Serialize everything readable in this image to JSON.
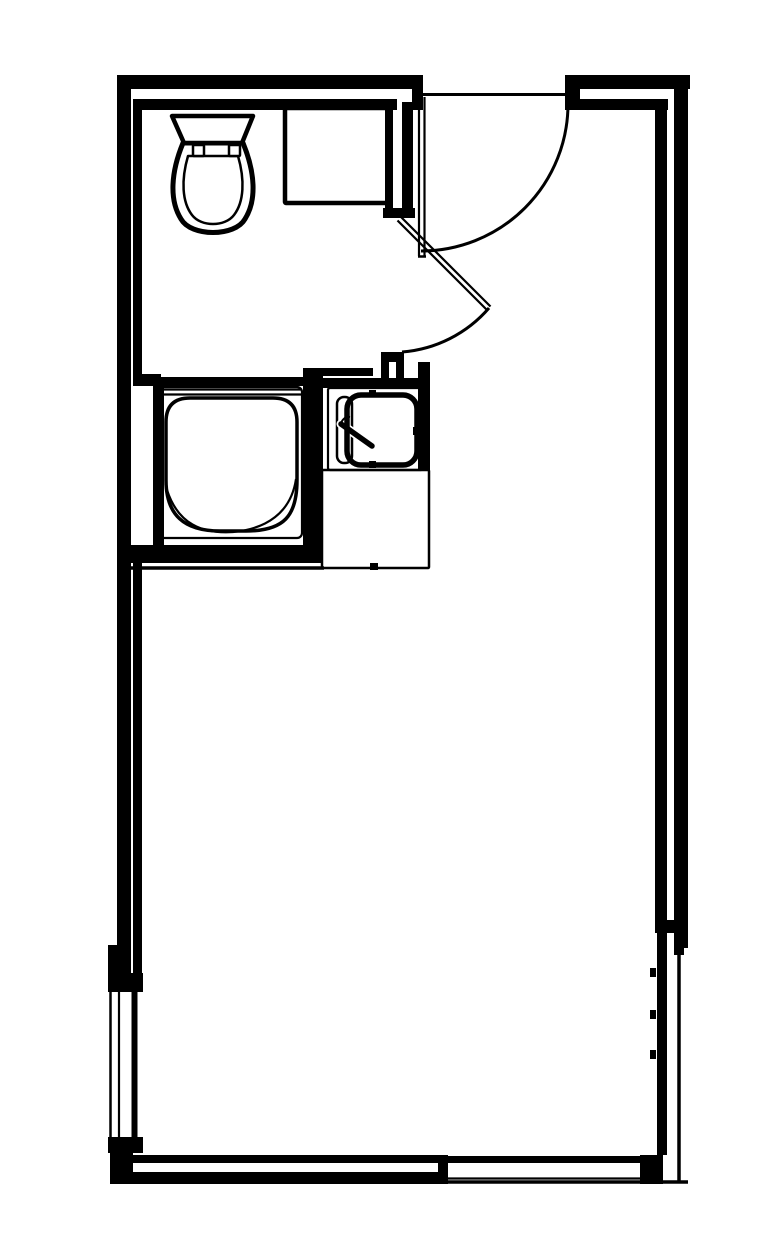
{
  "canvas": {
    "w": 783,
    "h": 1254,
    "bg": "#ffffff",
    "ink": "#000000"
  },
  "plan_meta": {
    "type": "architectural-floor-plan",
    "rooms": [
      "bathroom",
      "entry-vestibule",
      "main-room"
    ],
    "fixtures": [
      "toilet",
      "vanity-cabinet",
      "shower-stall",
      "sink",
      "entry-door",
      "bathroom-door",
      "left-window",
      "bottom-window"
    ]
  },
  "elements": [
    {
      "name": "wall-top-outer-left",
      "kind": "rect",
      "x": 117,
      "y": 75,
      "w": 306,
      "h": 14
    },
    {
      "name": "wall-top-inner-left",
      "kind": "rect",
      "x": 133,
      "y": 99,
      "w": 264,
      "h": 11
    },
    {
      "name": "entry-door-left-jamb",
      "kind": "rect",
      "x": 412,
      "y": 89,
      "w": 11,
      "h": 21
    },
    {
      "name": "wall-top-outer-right",
      "kind": "rect",
      "x": 565,
      "y": 75,
      "w": 125,
      "h": 14
    },
    {
      "name": "wall-top-inner-right",
      "kind": "rect",
      "x": 577,
      "y": 99,
      "w": 91,
      "h": 11
    },
    {
      "name": "entry-door-right-jamb",
      "kind": "rect",
      "x": 565,
      "y": 75,
      "w": 15,
      "h": 35
    },
    {
      "name": "wall-left-outer",
      "kind": "rect",
      "x": 117,
      "y": 75,
      "w": 14,
      "h": 873
    },
    {
      "name": "wall-left-outer-step",
      "kind": "rect",
      "x": 108,
      "y": 945,
      "w": 23,
      "h": 28
    },
    {
      "name": "wall-left-inner-upper",
      "kind": "rect",
      "x": 133,
      "y": 99,
      "w": 9,
      "h": 286
    },
    {
      "name": "bathroom-south-wall-el",
      "kind": "rect",
      "x": 133,
      "y": 374,
      "w": 28,
      "h": 12
    },
    {
      "name": "shower-left-wall",
      "kind": "rect",
      "x": 153,
      "y": 377,
      "w": 11,
      "h": 186
    },
    {
      "name": "shower-top-wall",
      "kind": "rect",
      "x": 161,
      "y": 377,
      "w": 144,
      "h": 9
    },
    {
      "name": "shower-right-wall",
      "kind": "rect",
      "x": 303,
      "y": 368,
      "w": 20,
      "h": 195
    },
    {
      "name": "sink-upper-wall-band",
      "kind": "rect",
      "x": 303,
      "y": 368,
      "w": 70,
      "h": 8
    },
    {
      "name": "sink-lower-wall-band",
      "kind": "rect",
      "x": 303,
      "y": 378,
      "w": 127,
      "h": 10
    },
    {
      "name": "door-stub-top",
      "kind": "rect",
      "x": 381,
      "y": 352,
      "w": 23,
      "h": 10
    },
    {
      "name": "door-stub-left-leg",
      "kind": "rect",
      "x": 381,
      "y": 360,
      "w": 8,
      "h": 19
    },
    {
      "name": "door-stub-right-leg",
      "kind": "rect",
      "x": 396,
      "y": 360,
      "w": 8,
      "h": 19
    },
    {
      "name": "sink-right-wall",
      "kind": "rect",
      "x": 418,
      "y": 362,
      "w": 12,
      "h": 108
    },
    {
      "name": "shower-bottom-wall",
      "kind": "rect",
      "x": 130,
      "y": 545,
      "w": 192,
      "h": 18
    },
    {
      "name": "wall-left-inner-lower",
      "kind": "rect",
      "x": 133,
      "y": 553,
      "w": 9,
      "h": 420
    },
    {
      "name": "left-window-top-jamb",
      "kind": "rect",
      "x": 108,
      "y": 973,
      "w": 35,
      "h": 19
    },
    {
      "name": "left-window-bottom-jamb",
      "kind": "rect",
      "x": 108,
      "y": 1137,
      "w": 35,
      "h": 16
    },
    {
      "name": "bottom-left-corner-post",
      "kind": "rect",
      "x": 110,
      "y": 1150,
      "w": 23,
      "h": 34
    },
    {
      "name": "wall-bottom-inner",
      "kind": "rect",
      "x": 133,
      "y": 1155,
      "w": 305,
      "h": 8
    },
    {
      "name": "wall-bottom-outer",
      "kind": "rect",
      "x": 110,
      "y": 1172,
      "w": 338,
      "h": 12
    },
    {
      "name": "bottom-window-left-jamb",
      "kind": "rect",
      "x": 438,
      "y": 1155,
      "w": 10,
      "h": 29
    },
    {
      "name": "bottom-window-inner-line",
      "kind": "rect",
      "x": 448,
      "y": 1156,
      "w": 192,
      "h": 7
    },
    {
      "name": "bottom-right-corner-post",
      "kind": "rect",
      "x": 640,
      "y": 1155,
      "w": 23,
      "h": 29
    },
    {
      "name": "wall-right-inner-upper",
      "kind": "rect",
      "x": 655,
      "y": 99,
      "w": 12,
      "h": 821
    },
    {
      "name": "wall-right-step-cap",
      "kind": "rect",
      "x": 655,
      "y": 920,
      "w": 28,
      "h": 13
    },
    {
      "name": "wall-right-inner-lower",
      "kind": "rect",
      "x": 657,
      "y": 933,
      "w": 10,
      "h": 222
    },
    {
      "name": "wall-right-outer",
      "kind": "rect",
      "x": 674,
      "y": 75,
      "w": 14,
      "h": 873
    },
    {
      "name": "wall-right-outer-step",
      "kind": "rect",
      "x": 674,
      "y": 943,
      "w": 10,
      "h": 12
    },
    {
      "name": "interior-wall-west-band",
      "kind": "rect",
      "x": 385,
      "y": 102,
      "w": 8,
      "h": 110
    },
    {
      "name": "interior-wall-east-band",
      "kind": "rect",
      "x": 402,
      "y": 102,
      "w": 11,
      "h": 115
    },
    {
      "name": "interior-wall-end-cap",
      "kind": "rect",
      "x": 383,
      "y": 208,
      "w": 32,
      "h": 10
    },
    {
      "name": "right-wall-tick-1",
      "kind": "rect",
      "x": 650,
      "y": 968,
      "w": 6,
      "h": 9
    },
    {
      "name": "right-wall-tick-2",
      "kind": "rect",
      "x": 650,
      "y": 1010,
      "w": 6,
      "h": 9
    },
    {
      "name": "right-wall-tick-3",
      "kind": "rect",
      "x": 650,
      "y": 1050,
      "w": 6,
      "h": 9
    },
    {
      "name": "counter-bottom-tick",
      "kind": "rect",
      "x": 370,
      "y": 563,
      "w": 8,
      "h": 7
    },
    {
      "name": "basin-top-nub",
      "kind": "rect",
      "x": 369,
      "y": 390,
      "w": 7,
      "h": 7
    },
    {
      "name": "basin-bottom-nub",
      "kind": "rect",
      "x": 369,
      "y": 461,
      "w": 7,
      "h": 7
    },
    {
      "name": "basin-right-nub",
      "kind": "rect",
      "x": 413,
      "y": 427,
      "w": 6,
      "h": 8
    },
    {
      "name": "entry-door-header-line",
      "kind": "line",
      "x1": 415,
      "y1": 94.5,
      "x2": 565,
      "y2": 94.5,
      "sw": 3
    },
    {
      "name": "entry-door-leaf-line-a",
      "kind": "line",
      "x1": 419,
      "y1": 97,
      "x2": 419,
      "y2": 256,
      "sw": 2.2
    },
    {
      "name": "entry-door-leaf-line-b",
      "kind": "line",
      "x1": 424.5,
      "y1": 97,
      "x2": 424.5,
      "y2": 256,
      "sw": 2.2
    },
    {
      "name": "entry-door-leaf-cap",
      "kind": "line",
      "x1": 418,
      "y1": 256.5,
      "x2": 426,
      "y2": 256.5,
      "sw": 2.5
    },
    {
      "name": "shower-glass-line-a",
      "kind": "line",
      "x1": 163,
      "y1": 389.5,
      "x2": 302,
      "y2": 389.5,
      "sw": 2.2
    },
    {
      "name": "shower-glass-line-b",
      "kind": "line",
      "x1": 163,
      "y1": 394.5,
      "x2": 302,
      "y2": 394.5,
      "sw": 2.2
    },
    {
      "name": "left-window-outer-line",
      "kind": "line",
      "x1": 110.5,
      "y1": 967,
      "x2": 110.5,
      "y2": 1140,
      "sw": 2.5
    },
    {
      "name": "left-window-glass-line",
      "kind": "line",
      "x1": 119,
      "y1": 992,
      "x2": 119,
      "y2": 1137,
      "sw": 2.2
    },
    {
      "name": "left-window-inner-line",
      "kind": "line",
      "x1": 134.5,
      "y1": 992,
      "x2": 134.5,
      "y2": 1137,
      "sw": 6
    },
    {
      "name": "right-wall-outer-line",
      "kind": "line",
      "x1": 679,
      "y1": 948,
      "x2": 679,
      "y2": 1183,
      "sw": 3.5
    },
    {
      "name": "bottom-window-glass-line",
      "kind": "line",
      "x1": 448,
      "y1": 1178.5,
      "x2": 640,
      "y2": 1178.5,
      "sw": 2.2
    },
    {
      "name": "bottom-wall-outer-line",
      "kind": "line",
      "x1": 448,
      "y1": 1182,
      "x2": 688,
      "y2": 1182,
      "sw": 3.5
    },
    {
      "name": "room-side-wall-line",
      "kind": "line",
      "x1": 130,
      "y1": 568,
      "x2": 324,
      "y2": 568,
      "sw": 3.5
    },
    {
      "name": "bathroom-door-leaf-line-a",
      "kind": "line",
      "x1": 397.5,
      "y1": 220.5,
      "x2": 487,
      "y2": 310,
      "sw": 2.2
    },
    {
      "name": "bathroom-door-leaf-line-b",
      "kind": "line",
      "x1": 401,
      "y1": 217,
      "x2": 490.5,
      "y2": 306.5,
      "sw": 2.2
    },
    {
      "name": "entry-door-swing-arc",
      "kind": "path",
      "d": "M 568,104 A 147,147 0 0 1 421,251",
      "sw": 3
    },
    {
      "name": "bathroom-door-swing-arc",
      "kind": "path",
      "d": "M 489,308 A 128,128 0 0 1 402,352",
      "sw": 3
    },
    {
      "name": "vanity-cabinet-outline",
      "kind": "rrect",
      "x": 285,
      "y": 108,
      "w": 105,
      "h": 95,
      "r": 1,
      "sw": 4.5
    },
    {
      "name": "shower-enclosure-outline",
      "kind": "rrect",
      "x": 159,
      "y": 387,
      "w": 143,
      "h": 151,
      "r": 5,
      "sw": 2.2
    },
    {
      "name": "shower-pan-body",
      "kind": "path",
      "d": "M 190,398 L 273,398 C 289,398 297,406 297,422 L 297,480 C 297,516 284,531 246,531 L 220,531 C 184,531 166,515 166,480 L 166,422 C 166,406 174,398 190,398 Z",
      "sw": 3.5,
      "fill": "#ffffff"
    },
    {
      "name": "shower-pan-floor-curve",
      "kind": "path",
      "d": "M 167,490 C 178,524 202,534 233,532 C 266,529 291,513 296,479",
      "sw": 2.2
    },
    {
      "name": "sink-counter-outline",
      "kind": "rrect",
      "x": 328,
      "y": 388,
      "w": 95,
      "h": 82,
      "r": 2,
      "sw": 2.2
    },
    {
      "name": "below-sink-counter-outline",
      "kind": "rrect",
      "x": 322,
      "y": 470,
      "w": 107,
      "h": 98,
      "r": 1,
      "sw": 2.5
    },
    {
      "name": "faucet-deck-outline",
      "kind": "rrect",
      "x": 337,
      "y": 397,
      "w": 15,
      "h": 66,
      "r": 7,
      "sw": 2.5
    },
    {
      "name": "faucet-lever-casing",
      "kind": "line",
      "x1": 341,
      "y1": 424,
      "x2": 372,
      "y2": 446,
      "sw": 9,
      "cap": "round",
      "stroke": "#ffffff"
    },
    {
      "name": "faucet-lever",
      "kind": "line",
      "x1": 341,
      "y1": 424,
      "x2": 372,
      "y2": 446,
      "sw": 5.5,
      "cap": "round"
    },
    {
      "name": "faucet-hook-detail",
      "kind": "path",
      "d": "M 350,417 a 8,8 0 0 0 -9,8",
      "sw": 2
    },
    {
      "name": "sink-basin-outline",
      "kind": "rrect",
      "x": 347,
      "y": 395,
      "w": 70,
      "h": 70,
      "r": 14,
      "sw": 5.5
    },
    {
      "name": "toilet-bowl-outer",
      "kind": "path",
      "d": "M 183,143 C 171,172 169,200 181,219 C 191,237 235,237 245,219 C 257,200 255,172 243,143 Z",
      "sw": 5,
      "fill": "#ffffff"
    },
    {
      "name": "toilet-bowl-inner",
      "kind": "path",
      "d": "M 188,156 L 238,156 C 245,180 244,202 234,215 C 225,227 201,227 192,215 C 182,202 181,180 188,156 Z",
      "sw": 2.5
    },
    {
      "name": "toilet-tank",
      "kind": "path",
      "d": "M 172,116 L 253,116 L 242,143 L 184,143 Z",
      "sw": 4.5,
      "fill": "#ffffff"
    },
    {
      "name": "toilet-seat-hinge-left",
      "kind": "rrect",
      "x": 193,
      "y": 145,
      "w": 11,
      "h": 11,
      "r": 1,
      "sw": 2.5,
      "fill": "#ffffff"
    },
    {
      "name": "toilet-seat-hinge-right",
      "kind": "rrect",
      "x": 229,
      "y": 145,
      "w": 11,
      "h": 11,
      "r": 1,
      "sw": 2.5,
      "fill": "#ffffff"
    }
  ]
}
